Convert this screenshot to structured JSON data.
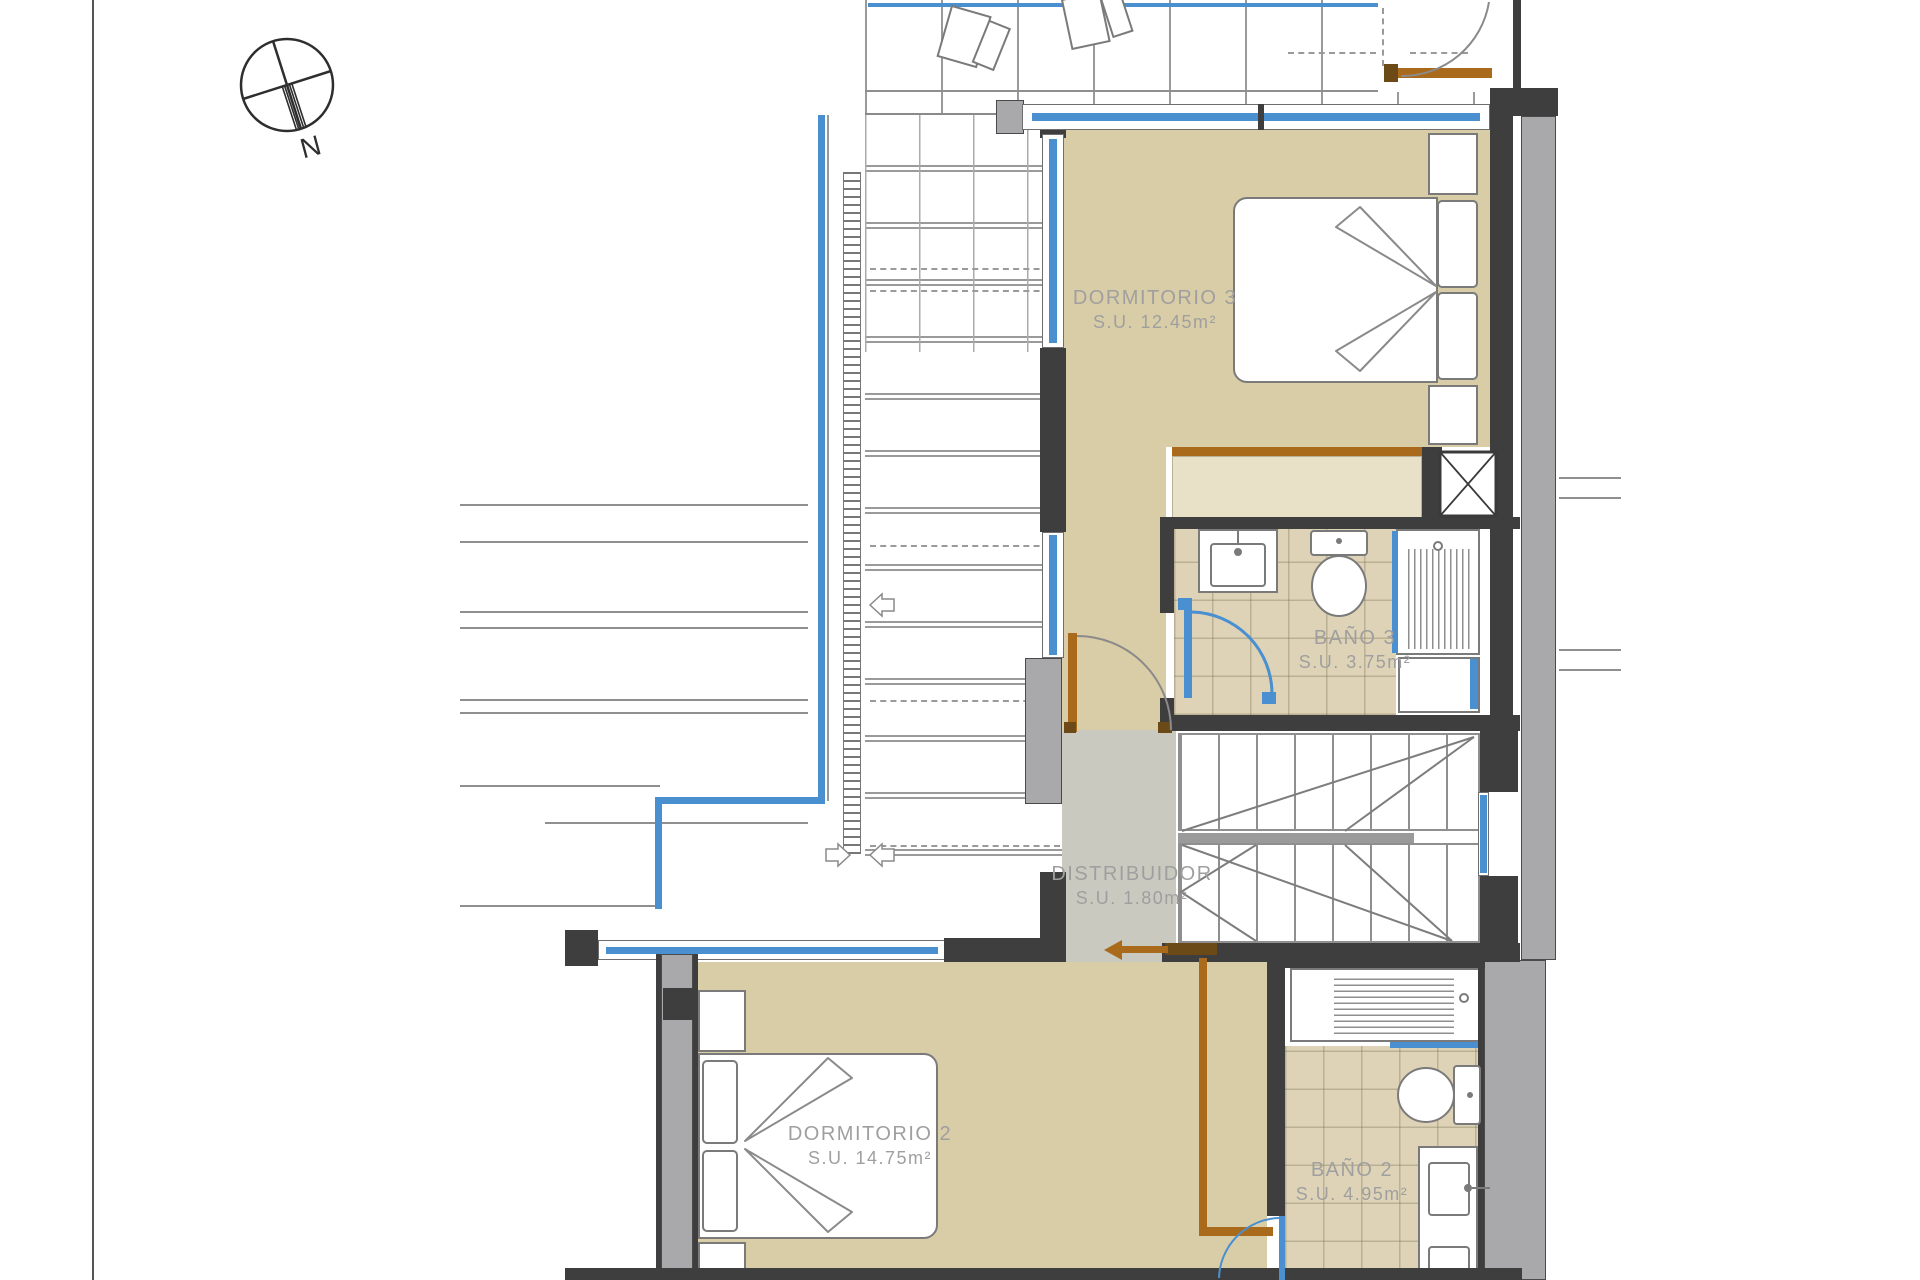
{
  "compass": {
    "label": "N"
  },
  "rooms": [
    {
      "id": "dormitorio-3",
      "name": "DORMITORIO 3",
      "area": "S.U. 12.45m²"
    },
    {
      "id": "bano-3",
      "name": "BAÑO 3",
      "area": "S.U. 3.75m²"
    },
    {
      "id": "distribuidor",
      "name": "DISTRIBUIDOR",
      "area": "S.U. 1.80m²"
    },
    {
      "id": "dormitorio-2",
      "name": "DORMITORIO 2",
      "area": "S.U. 14.75m²"
    },
    {
      "id": "bano-2",
      "name": "BAÑO 2",
      "area": "S.U. 4.95m²"
    }
  ],
  "colors": {
    "wall_dark": "#3e3e3e",
    "wall_gray": "#a9a9ab",
    "floor_tan": "#d9cda7",
    "bath_tile": "#ded3b6",
    "hall_gray": "#c9c9c0",
    "glazing_blue": "#4a8fd0",
    "carpentry_brown": "#a96a1c",
    "label_gray": "#9f9f9f"
  }
}
